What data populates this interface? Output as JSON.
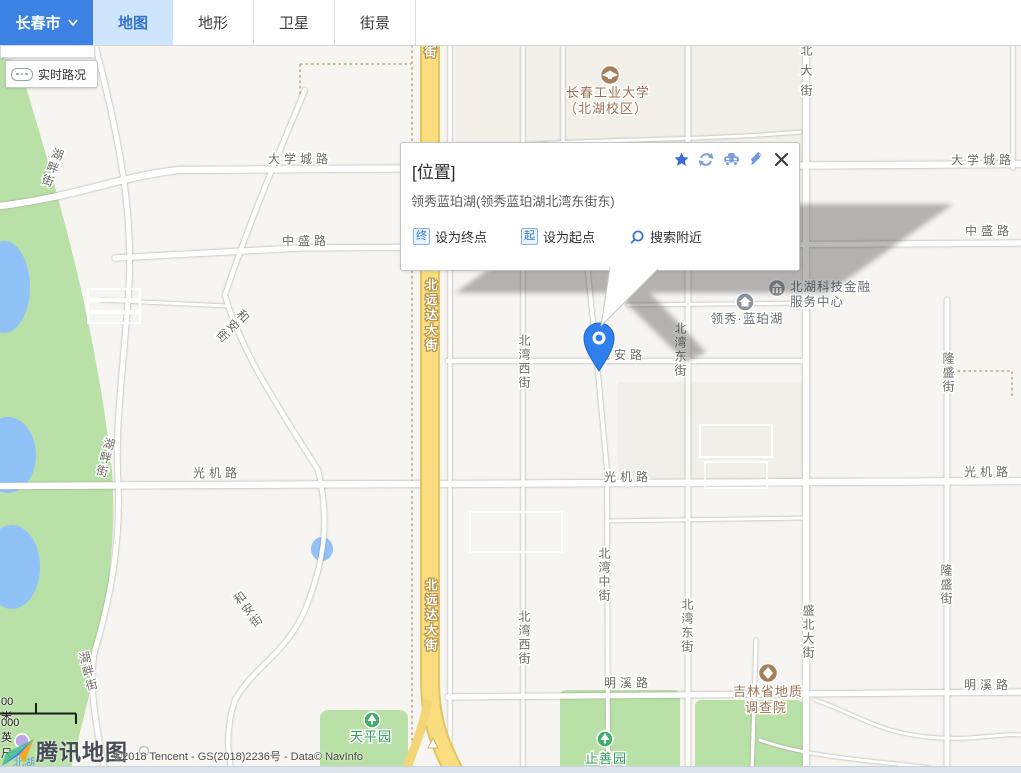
{
  "toolbar": {
    "city": "长春市",
    "tabs": [
      {
        "label": "地图"
      },
      {
        "label": "地形"
      },
      {
        "label": "卫星"
      },
      {
        "label": "街景"
      }
    ]
  },
  "traffic": {
    "label": "实时路况"
  },
  "popup": {
    "title": "[位置]",
    "address": "领秀蓝珀湖(领秀蓝珀湖北湾东街东)",
    "actions": {
      "end_badge": "终",
      "end_label": "设为终点",
      "start_badge": "起",
      "start_label": "设为起点",
      "nearby_label": "搜索附近"
    }
  },
  "map": {
    "labels": {
      "daxuecheng": "大学城路",
      "zhongsheng": "中盛路",
      "hupan": "湖畔街",
      "hean": "和安街",
      "beiyuanda": "北远达大街",
      "jie": "街",
      "beiwanxi": "北湾西街",
      "yaan": "雅安路",
      "beiwandong": "北湾东街",
      "beiwanzhong": "北湾中街",
      "shengbei": "盛北大街",
      "longsheng": "隆盛街",
      "guangji": "光机路",
      "mingxi": "明溪路",
      "beihu": "北湖"
    },
    "pois": {
      "university_line1": "长春工业大学",
      "university_line2": "（北湖校区）",
      "lingxiu": "领秀·蓝珀湖",
      "finance_line1": "北湖科技金融",
      "finance_line2": "服务中心",
      "geology_line1": "吉林省地质",
      "geology_line2": "调查院",
      "tianping": "天平园",
      "zhishan": "止善园"
    }
  },
  "scalebar": {
    "metric": "00 米",
    "imperial": "000 英尺"
  },
  "footer": {
    "logo": "腾讯地图",
    "copyright": "©2018 Tencent - GS(2018)2236号 - Data© NavInfo"
  },
  "colors": {
    "toolbar_city_bg": "#3c82e4",
    "tab_active_bg": "#cfe5fb",
    "tab_active_text": "#3273cc",
    "pin_blue": "#2f80ed",
    "road_yellow": "#f9dd7f",
    "park_green": "#b9e1a7",
    "water_blue": "#90c2f8",
    "action_blue": "#3478cf"
  }
}
